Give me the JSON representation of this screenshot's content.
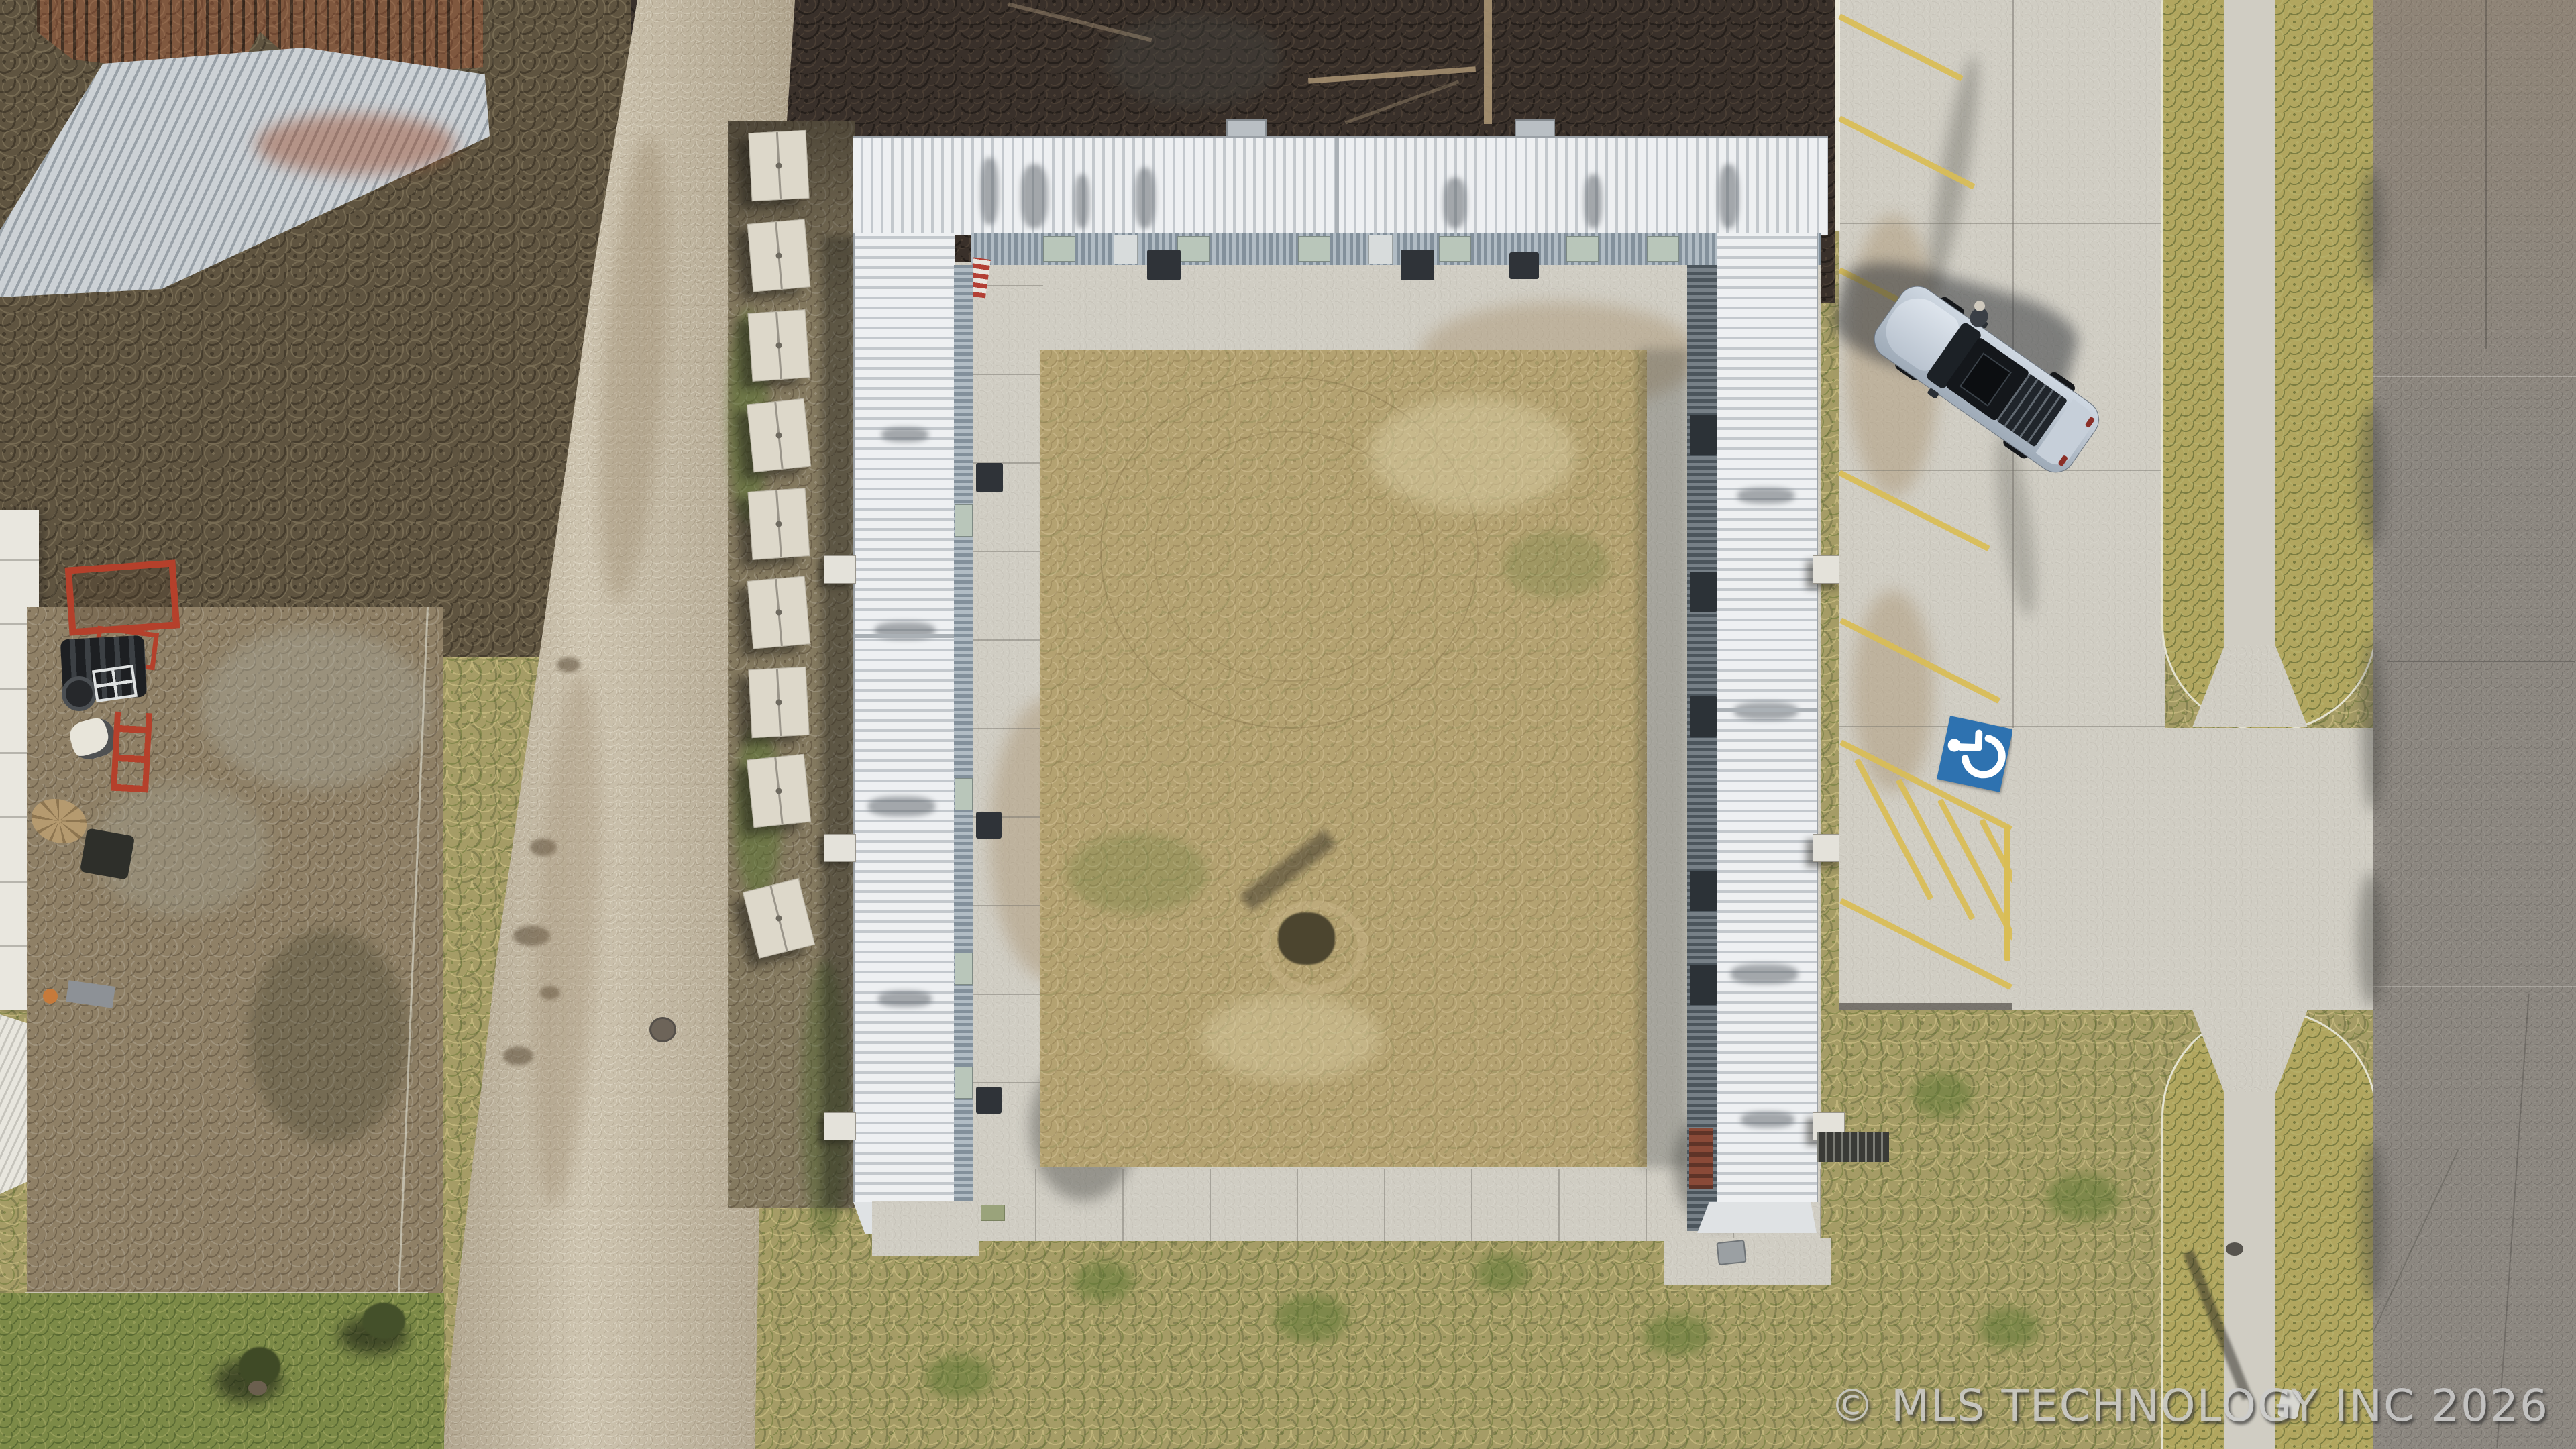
{
  "watermark": {
    "text": "© MLS TECHNOLOGY INC 2026"
  },
  "scene": {
    "type": "aerial drone photograph",
    "description": "Overhead view of a U-shaped white corrugated metal roof building around a dirt courtyard, with a concrete parking lot, one parked silver SUV, an accessible parking space, a gravel road, a fenced dirt lot with equipment, and an asphalt street.",
    "counts": {
      "building_wings": 3,
      "storage_units": 9,
      "parked_vehicles": 1,
      "people": 1,
      "accessible_parking_spaces": 1,
      "courtyard_trees": 1,
      "rooftop_vents": 2
    },
    "markings": {
      "parking_stall_lines": "yellow diagonal",
      "access_aisle": "yellow cross-hatched",
      "accessible_symbol": "white wheelchair on blue square"
    }
  },
  "icons": {
    "wheelchair": "wheelchair-icon"
  },
  "colors": {
    "watermark": "#cdcdcd",
    "line-yellow": "#d9bd55",
    "handicap-blue": "#2e72b0",
    "roof-white": "#e9ebec",
    "concrete": "#d0cdc3",
    "asphalt": "#8c8780",
    "gravel": "#bdb29c",
    "grass-olive": "#a59c66",
    "lawn": "#7c8a47",
    "dirt": "#94846a",
    "brush": "#39302a",
    "rust": "#8a4130",
    "car-silver": "#b8c2cd",
    "red-equipment": "#b5402b",
    "white-unit": "#ddd8ca"
  }
}
